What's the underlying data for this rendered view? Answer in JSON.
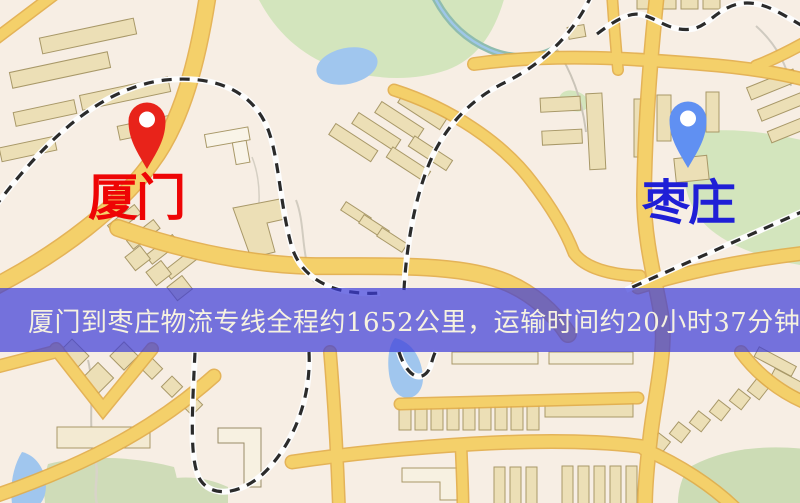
{
  "banner": {
    "text": "厦门到枣庄物流专线全程约1652公里，运输时间约20小时37分钟.",
    "origin": "厦门",
    "destination": "枣庄",
    "distance_km": "1652",
    "duration_hours": "20",
    "duration_minutes": "37",
    "overlay_color": "#3c3cd8",
    "text_color": "#f6f2e0"
  },
  "markers": {
    "origin": {
      "label": "厦门",
      "pin_color": "#e8231a",
      "label_color": "#ee0505"
    },
    "destination": {
      "label": "枣庄",
      "pin_color": "#6090f2",
      "label_color": "#1f1fd6"
    }
  },
  "map": {
    "colors": {
      "background": "#f7f0e4",
      "road": "#f4d06a",
      "road_casing": "#e2ad49",
      "building": "#ecdfb6",
      "building_outline": "#a89868",
      "park": "#d3e5bd",
      "water": "#a0c6ee",
      "railway_dash": "#2b2b2b",
      "railway_casing": "#fdfdfd"
    }
  }
}
